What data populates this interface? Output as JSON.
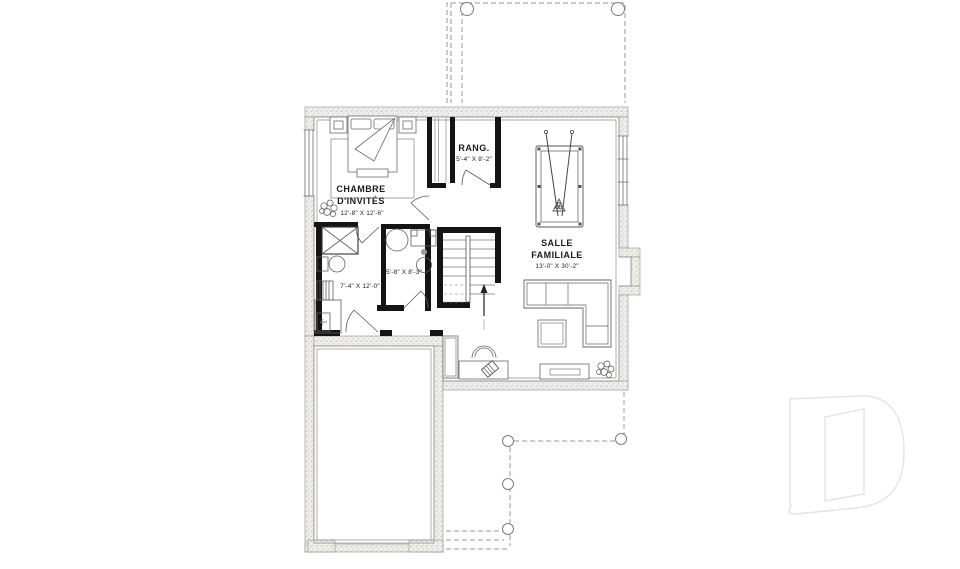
{
  "document": {
    "type": "basement floor plan drawing",
    "language": "French"
  },
  "colors": {
    "foundation_fill": "#efede9",
    "foundation_speckle": "#b3afa8",
    "interior_wall": "#141414",
    "line": "#5a5a5a",
    "dashed_line": "#9a9a9a",
    "watermark": "#e4e4e4",
    "background": "#ffffff"
  },
  "rooms": {
    "guest_bedroom": {
      "name1": "CHAMBRE",
      "name2": "D'INVITÉS",
      "dims": "12'-8\" X 12'-6\""
    },
    "storage": {
      "name1": "RANG.",
      "dims": "5'-4\" X 8'-2\""
    },
    "family_room": {
      "name1": "SALLE",
      "name2": "FAMILIALE",
      "dims": "13'-0\" X 30'-2\""
    },
    "laundry": {
      "dims": "7'-4\" X 12'-0\""
    },
    "bathroom": {
      "dims": "5'-8\" X 8'-3\""
    }
  },
  "icons": {
    "watermark_letter": "D"
  }
}
